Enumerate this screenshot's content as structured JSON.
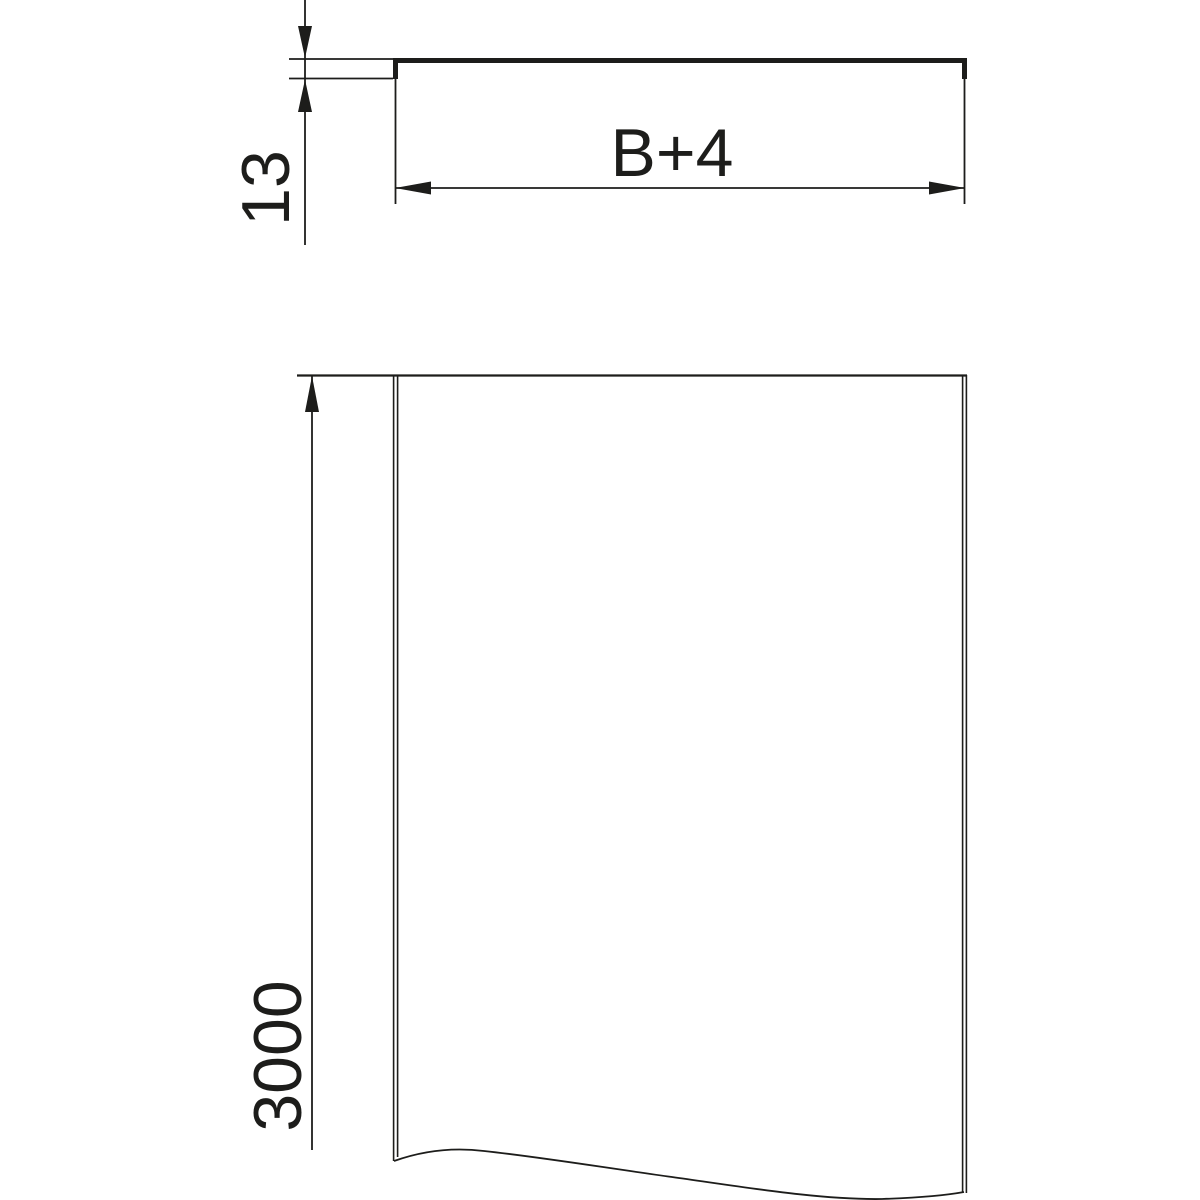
{
  "drawing": {
    "type": "technical-dimension-drawing",
    "views": {
      "cross_section": "cover profile with edge lips",
      "plan": "cover plan view with break line"
    }
  },
  "dimensions": {
    "thickness": "13",
    "width": "B+4",
    "length": "3000"
  },
  "colors": {
    "line": "#1d1d1b",
    "background": "#ffffff"
  }
}
